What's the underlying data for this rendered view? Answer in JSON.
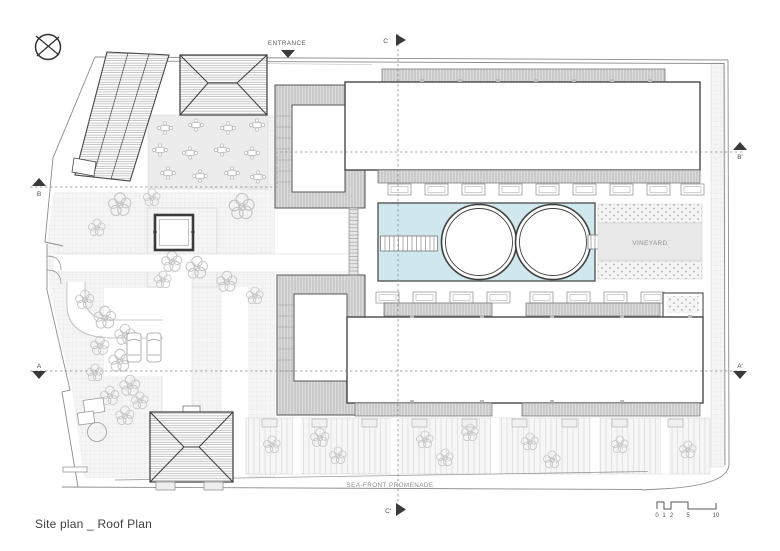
{
  "drawing": {
    "title": "Site plan _ Roof Plan",
    "labels": {
      "entrance": "ENTRANCE",
      "vineyard": "VINEYARD",
      "promenade": "SEA-FRONT PROMENADE"
    },
    "sections": {
      "a": "A",
      "a_prime": "A'",
      "b": "B",
      "b_prime": "B'",
      "c": "C",
      "c_prime": "C'"
    },
    "scale_bar": {
      "ticks": [
        "0",
        "1",
        "2",
        "5",
        "10"
      ]
    },
    "colors": {
      "pool": "#cfe7ed",
      "roof_band": "#dcdcdc",
      "outline": "#474747",
      "muted_text": "#8a8a8a"
    }
  }
}
